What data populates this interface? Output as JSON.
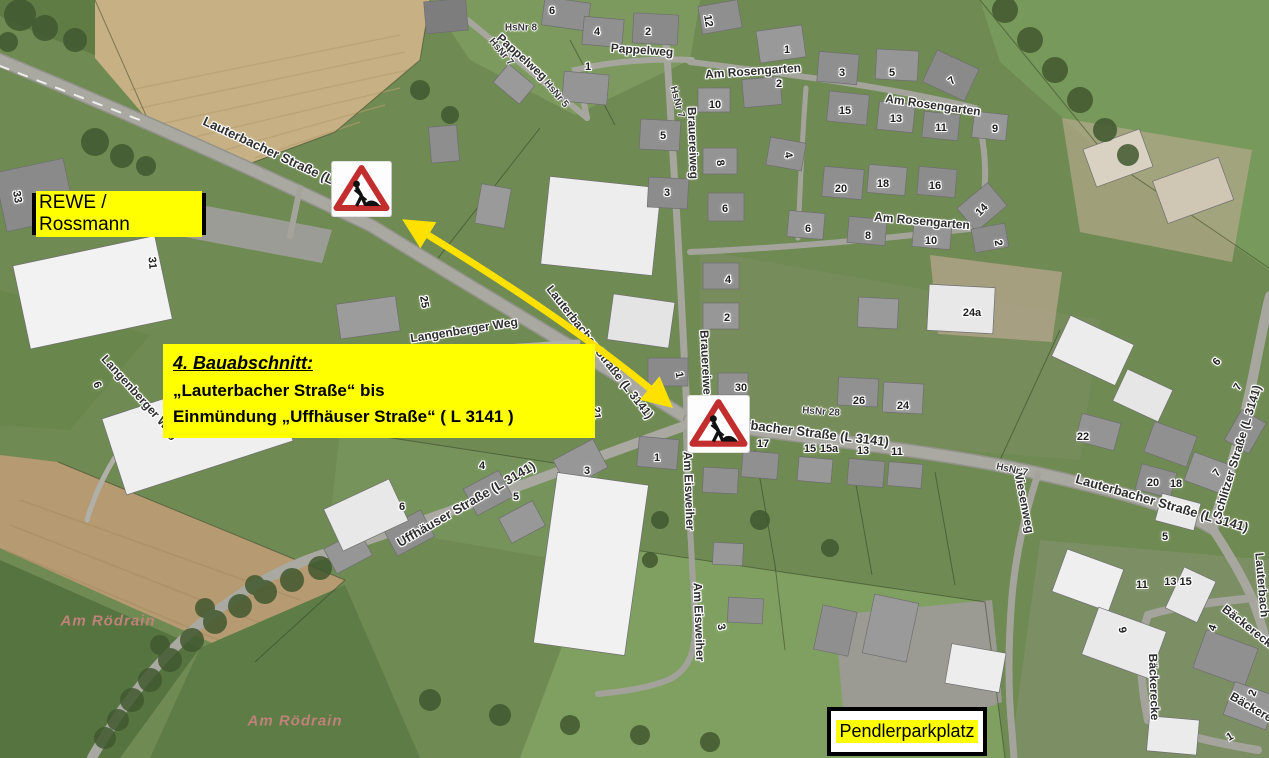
{
  "annotations": {
    "rewe_box": {
      "text": "REWE / Rossmann"
    },
    "pendler_box": {
      "text": "Pendlerparkplatz"
    },
    "info_box": {
      "line1": "4. Bauabschnitt:",
      "line2": "„Lauterbacher Straße“ bis",
      "line3": "Einmündung „Uffhäuser Straße“ ( L 3141 )"
    },
    "signs": [
      {
        "icon": "roadworks-sign",
        "x": 331,
        "y": 161,
        "w": 61,
        "h": 56
      },
      {
        "icon": "roadworks-sign",
        "x": 687,
        "y": 395,
        "w": 63,
        "h": 58
      }
    ],
    "arrow": {
      "icon": "double-headed-arrow",
      "color": "#ffe100"
    },
    "colors": {
      "highlight": "#ffff00",
      "sign_red": "#c22e2e"
    }
  },
  "map_labels": {
    "streets": [
      {
        "text": "Lauterbacher Straße (L 3141)",
        "x": 285,
        "y": 158,
        "rot": 25,
        "size": 13
      },
      {
        "text": "Lauterbacher Straße (L 3141)",
        "x": 600,
        "y": 352,
        "rot": 52,
        "size": 12
      },
      {
        "text": "Lauterbacher Straße (L 3141)",
        "x": 800,
        "y": 431,
        "rot": 7,
        "size": 13
      },
      {
        "text": "Lauterbacher Straße (L 3141)",
        "x": 1162,
        "y": 503,
        "rot": 16,
        "size": 13
      },
      {
        "text": "Pappelweg",
        "x": 522,
        "y": 57,
        "rot": 42,
        "size": 12
      },
      {
        "text": "Pappelweg",
        "x": 642,
        "y": 50,
        "rot": 4,
        "size": 12
      },
      {
        "text": "Am Rosengarten",
        "x": 753,
        "y": 71,
        "rot": -4,
        "size": 12
      },
      {
        "text": "Am Rosengarten",
        "x": 933,
        "y": 105,
        "rot": 8,
        "size": 12
      },
      {
        "text": "Am Rosengarten",
        "x": 922,
        "y": 221,
        "rot": 5,
        "size": 12
      },
      {
        "text": "Brauereiweg",
        "x": 693,
        "y": 143,
        "rot": 88,
        "size": 12
      },
      {
        "text": "Brauereiweg",
        "x": 706,
        "y": 366,
        "rot": 87,
        "size": 12
      },
      {
        "text": "Langenberger Weg",
        "x": 464,
        "y": 330,
        "rot": -9,
        "size": 12
      },
      {
        "text": "Langenberger Weg",
        "x": 140,
        "y": 397,
        "rot": 48,
        "size": 12
      },
      {
        "text": "Uffhäuser Straße (L 3141)",
        "x": 466,
        "y": 504,
        "rot": -30,
        "size": 13
      },
      {
        "text": "Am Eisweiher",
        "x": 689,
        "y": 491,
        "rot": 88,
        "size": 12
      },
      {
        "text": "Am Eisweiher",
        "x": 699,
        "y": 622,
        "rot": 88,
        "size": 12
      },
      {
        "text": "Wiesenweg",
        "x": 1024,
        "y": 501,
        "rot": 79,
        "size": 12
      },
      {
        "text": "Schlitzer Straße (L 3141)",
        "x": 1237,
        "y": 452,
        "rot": -73,
        "size": 12
      },
      {
        "text": "Bäckerecke",
        "x": 1154,
        "y": 687,
        "rot": 88,
        "size": 12
      },
      {
        "text": "Bäckerecke",
        "x": 1250,
        "y": 628,
        "rot": 38,
        "size": 12
      },
      {
        "text": "Bäckerecke",
        "x": 1260,
        "y": 712,
        "rot": 30,
        "size": 12
      },
      {
        "text": "Lauterbach",
        "x": 1262,
        "y": 585,
        "rot": 85,
        "size": 12
      }
    ],
    "hsnr": [
      {
        "text": "HsNr 8",
        "x": 521,
        "y": 28,
        "rot": 0
      },
      {
        "text": "HsNr 7",
        "x": 501,
        "y": 52,
        "rot": 50
      },
      {
        "text": "HsNr 5",
        "x": 556,
        "y": 94,
        "rot": 50
      },
      {
        "text": "HsNr 7",
        "x": 677,
        "y": 102,
        "rot": 75
      },
      {
        "text": "HsNr 28",
        "x": 821,
        "y": 412,
        "rot": 4
      },
      {
        "text": "HsNr 7",
        "x": 1012,
        "y": 470,
        "rot": 12
      }
    ],
    "house_numbers": [
      {
        "text": "6",
        "x": 552,
        "y": 11
      },
      {
        "text": "4",
        "x": 597,
        "y": 32
      },
      {
        "text": "2",
        "x": 648,
        "y": 32
      },
      {
        "text": "1",
        "x": 588,
        "y": 67
      },
      {
        "text": "12",
        "x": 708,
        "y": 21,
        "rot": 80
      },
      {
        "text": "1",
        "x": 787,
        "y": 50
      },
      {
        "text": "3",
        "x": 842,
        "y": 73
      },
      {
        "text": "5",
        "x": 892,
        "y": 73
      },
      {
        "text": "7",
        "x": 952,
        "y": 81,
        "rot": -40
      },
      {
        "text": "2",
        "x": 779,
        "y": 84
      },
      {
        "text": "10",
        "x": 715,
        "y": 105
      },
      {
        "text": "15",
        "x": 845,
        "y": 111
      },
      {
        "text": "13",
        "x": 896,
        "y": 119
      },
      {
        "text": "11",
        "x": 941,
        "y": 128
      },
      {
        "text": "9",
        "x": 995,
        "y": 129
      },
      {
        "text": "5",
        "x": 663,
        "y": 136
      },
      {
        "text": "4",
        "x": 788,
        "y": 155,
        "rot": 80
      },
      {
        "text": "8",
        "x": 720,
        "y": 163,
        "rot": 80
      },
      {
        "text": "3",
        "x": 667,
        "y": 193
      },
      {
        "text": "20",
        "x": 841,
        "y": 189
      },
      {
        "text": "18",
        "x": 883,
        "y": 184
      },
      {
        "text": "16",
        "x": 935,
        "y": 186
      },
      {
        "text": "14",
        "x": 982,
        "y": 210,
        "rot": -45
      },
      {
        "text": "6",
        "x": 725,
        "y": 209
      },
      {
        "text": "6",
        "x": 808,
        "y": 229
      },
      {
        "text": "8",
        "x": 868,
        "y": 236
      },
      {
        "text": "10",
        "x": 931,
        "y": 241
      },
      {
        "text": "2",
        "x": 998,
        "y": 243,
        "rot": 80
      },
      {
        "text": "4",
        "x": 728,
        "y": 280
      },
      {
        "text": "2",
        "x": 727,
        "y": 318
      },
      {
        "text": "1",
        "x": 679,
        "y": 375,
        "rot": 80
      },
      {
        "text": "30",
        "x": 741,
        "y": 388
      },
      {
        "text": "25",
        "x": 424,
        "y": 302,
        "rot": 80
      },
      {
        "text": "21",
        "x": 596,
        "y": 413,
        "rot": 85
      },
      {
        "text": "33",
        "x": 17,
        "y": 197,
        "rot": 80
      },
      {
        "text": "31",
        "x": 152,
        "y": 263,
        "rot": 85
      },
      {
        "text": "6",
        "x": 97,
        "y": 385,
        "rot": 70
      },
      {
        "text": "24a",
        "x": 972,
        "y": 313
      },
      {
        "text": "26",
        "x": 859,
        "y": 401
      },
      {
        "text": "24",
        "x": 903,
        "y": 406
      },
      {
        "text": "17",
        "x": 763,
        "y": 444
      },
      {
        "text": "15",
        "x": 810,
        "y": 449
      },
      {
        "text": "15a",
        "x": 829,
        "y": 449
      },
      {
        "text": "13",
        "x": 863,
        "y": 451
      },
      {
        "text": "11",
        "x": 897,
        "y": 452
      },
      {
        "text": "1",
        "x": 657,
        "y": 458
      },
      {
        "text": "3",
        "x": 587,
        "y": 471
      },
      {
        "text": "4",
        "x": 482,
        "y": 466
      },
      {
        "text": "5",
        "x": 516,
        "y": 497
      },
      {
        "text": "6",
        "x": 402,
        "y": 507
      },
      {
        "text": "3",
        "x": 721,
        "y": 627,
        "rot": 80
      },
      {
        "text": "22",
        "x": 1083,
        "y": 437
      },
      {
        "text": "20",
        "x": 1153,
        "y": 483
      },
      {
        "text": "18",
        "x": 1176,
        "y": 484
      },
      {
        "text": "7",
        "x": 1217,
        "y": 473,
        "rot": -50
      },
      {
        "text": "6",
        "x": 1217,
        "y": 362,
        "rot": -50
      },
      {
        "text": "7",
        "x": 1238,
        "y": 387,
        "rot": -60
      },
      {
        "text": "5",
        "x": 1165,
        "y": 537
      },
      {
        "text": "11",
        "x": 1142,
        "y": 585
      },
      {
        "text": "13 15",
        "x": 1178,
        "y": 582
      },
      {
        "text": "9",
        "x": 1122,
        "y": 630,
        "rot": 80
      },
      {
        "text": "4",
        "x": 1213,
        "y": 628,
        "rot": -70
      },
      {
        "text": "2",
        "x": 1253,
        "y": 693,
        "rot": -70
      },
      {
        "text": "1",
        "x": 1230,
        "y": 737,
        "rot": -30
      }
    ],
    "areas": [
      {
        "text": "Am Rödrain",
        "x": 108,
        "y": 621
      },
      {
        "text": "Am Rödrain",
        "x": 295,
        "y": 721
      }
    ]
  }
}
